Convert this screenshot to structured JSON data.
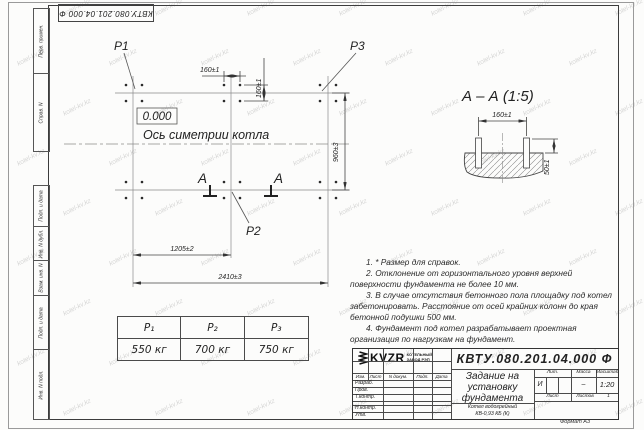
{
  "sheet": {
    "format_label": "Формат А3"
  },
  "watermark": {
    "text": "kotel-kv.kz"
  },
  "corner_stamp": {
    "text": "КВТУ.080.201.04.000  Ф"
  },
  "side_columns": {
    "top": [
      "Перв. примен.",
      "Справ. N"
    ],
    "bottom": [
      "Подп. и дата",
      "Инв. N дубл.",
      "Взам. инв. N",
      "Подп. и дата",
      "Инв. N подл."
    ]
  },
  "plan": {
    "point_labels": [
      "P1",
      "P2",
      "P3"
    ],
    "level_mark": "0.000",
    "axis_label": "Ось симетрии котла",
    "section_letter": "A",
    "dims": {
      "bolt_h": "160±1",
      "bolt_v": "160±1",
      "height": "960±3",
      "half_width": "1205±2",
      "full_width": "2410±3"
    }
  },
  "section_view": {
    "title": "А – А (1:5)",
    "dims": {
      "spacing": "160±1",
      "protrusion": "50±1"
    }
  },
  "notes": [
    "1. * Размер для справок.",
    "2. Отклонение от горизонтального уровня верхней поверхности фундамента не более 10 мм.",
    "3. В случае отсутствия бетонного пола площадку под котел забетонировать. Расстояние от осей крайних колонн до края бетонной подушки 500 мм.",
    "4. Фундамент под котел разрабатывает проектная организация по нагрузкам на фундамент."
  ],
  "load_table": {
    "headers": [
      "P₁",
      "P₂",
      "P₃"
    ],
    "values": [
      "550 кг",
      "700 кг",
      "750 кг"
    ]
  },
  "title_block": {
    "doc_number": "КВТУ.080.201.04.000  Ф",
    "title_lines": [
      "Задание на",
      "установку",
      "фундамента"
    ],
    "product_lines": [
      "Котел водогрейный",
      "КВ-0,93 КБ (К)"
    ],
    "header_cells": [
      "Изм.",
      "Лист",
      "N докум.",
      "Подп.",
      "Дата"
    ],
    "roles": [
      "Разраб.",
      "Пров.",
      "Т.контр.",
      "Н.контр.",
      "Утв."
    ],
    "lit": {
      "label": "Лит.",
      "value": "И"
    },
    "mass": {
      "label": "Масса",
      "value": "–"
    },
    "scale": {
      "label": "Масштаб",
      "value": "1:20"
    },
    "sheet": {
      "label": "Лист"
    },
    "sheets": {
      "label": "Листов",
      "value": "1"
    },
    "company": {
      "logo": "KVZR",
      "lines": [
        "КОТЕЛЬНЫЙ",
        "ЗАВОД РЭП"
      ]
    }
  }
}
